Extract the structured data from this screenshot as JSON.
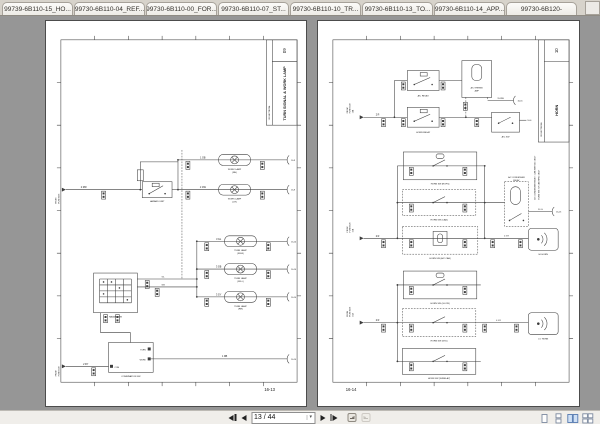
{
  "colors": {
    "canvas_bg": "#969696",
    "page_bg": "#ffffff",
    "view_active_fill": "#cfe0f5",
    "view_active_border": "#5579b0"
  },
  "tabs": [
    {
      "label": "99739-6B110-15_HO..."
    },
    {
      "label": "99730-6B110-04_REF..."
    },
    {
      "label": "99730-6B110-00_FOR..."
    },
    {
      "label": "99730-6B110-07_ST..."
    },
    {
      "label": "99730-6B110-10_TR..."
    },
    {
      "label": "99730-6B110-13_TO..."
    },
    {
      "label": "99730-6B110-14_APP..."
    },
    {
      "label": "99730-6B120-"
    }
  ],
  "statusbar": {
    "page_field": "13 / 44"
  },
  "left_page": {
    "sheet_no": "09",
    "section": "16 ELECTRICAL",
    "title": "TURN SIGNAL & WORK LAMP",
    "page_no": "16-13",
    "entry_top_1": "FROM",
    "entry_top_2": "FUSE BOX",
    "wire_feed": "2 RW",
    "hazard_unit": "HAZARD UNIT",
    "rowA_wire": "1 GB",
    "rowA_lamp_1": "WORK LAMP",
    "rowA_lamp_2": "(RH)",
    "rowA_ref": "16-9",
    "rowB_wire": "1 GW",
    "rowB_lamp_1": "WORK LAMP",
    "rowB_lamp_2": "(LH)",
    "rowB_ref": "16-9",
    "turn_rows": [
      {
        "wire": "3 GL",
        "lamp_1": "TURN LAMP",
        "lamp_2": "(FR-R)",
        "ref": "16-14"
      },
      {
        "wire": "3 GB",
        "lamp_1": "TURN LAMP",
        "lamp_2": "(FR-L)",
        "ref": "16-14"
      },
      {
        "wire": "3 GY",
        "lamp_1": "TURN LAMP",
        "lamp_2": "(RR)",
        "ref": "16-14"
      }
    ],
    "hazard_sw": "HAZARD SW",
    "hazard_out1": "GL",
    "hazard_out2": "GB",
    "comb_sw": "COMBINATION SW",
    "pin_turn": "TURN",
    "pin_work": "WORK",
    "pin_com": "COM",
    "entry_bot_1": "FROM",
    "entry_bot_2": "FUSE BOX",
    "wire_bot": "2 RY",
    "wire_out": "1 RB",
    "bot_ref": "16-14"
  },
  "right_page": {
    "sheet_no": "10",
    "section": "16 ELECTRICAL",
    "title": "HORN",
    "page_no": "16-14",
    "note_1": "A/C CONDENSER RELAY : CAB WITH A/C ONLY",
    "note_2": "HORN SW : W/ CAB SPEC ONLY",
    "entry1_1": "FROM",
    "entry1_2": "FUSE BOX",
    "entry1_3": "10A",
    "wire1": "2 R",
    "ac_relay": "A/C RELAY",
    "thermo": "A/C THERMO",
    "thermo2": "AMP",
    "thermo_wire": "15 BW",
    "thermo_ref": "16-15",
    "horn_relay": "HORN RELAY",
    "ac_sw": "A/C SW",
    "ac_sw_ref": "16-6",
    "entry2_1": "FROM",
    "entry2_2": "FUSE BOX",
    "entry2_3": "15A",
    "wire2": "2 R",
    "box_a": "HORN SW (ROPS)",
    "box_b": "HORN SW (CAB)",
    "box_c": "HORN SW (A/C CAB)",
    "condenser_1": "A/C CONDENSER",
    "condenser_2": "RELAY",
    "cond_wire": "10 G",
    "cond_ref": "16-15",
    "hi_wire": "4 GY",
    "hi_horn": "HI HORN",
    "entry3_1": "FROM",
    "entry3_2": "FUSE BOX",
    "entry3_3": "15A",
    "wire3": "2 R",
    "box_d": "HORN SW (GLOW)",
    "box_e": "HORN SW (STD)",
    "box_f": "HORN SW (W/RELAY)",
    "lo_wire": "4 GY",
    "lo_horn": "LO HORN"
  }
}
